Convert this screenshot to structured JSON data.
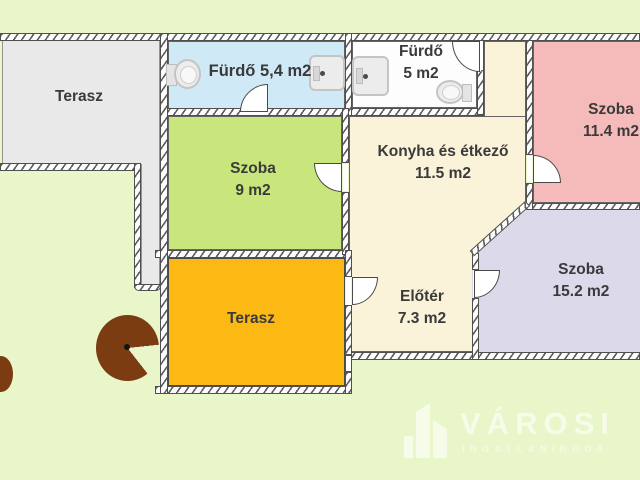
{
  "floorplan": {
    "background": "#e9f6c9",
    "wall_fill": "#fdfdfd",
    "wall_line": "#4f4f4f",
    "text_color": "#3a3a3a",
    "rooms": [
      {
        "name": "terasz-upper",
        "label": "Terasz",
        "area": "",
        "color": "#e9e9e9"
      },
      {
        "name": "furdo-small",
        "label": "Fürdő 5,4 m2",
        "area": "",
        "color": "#cfe9f6"
      },
      {
        "name": "furdo-large",
        "label": "Fürdő",
        "area": "5 m2",
        "color": "#fdfdfd"
      },
      {
        "name": "szoba-pink",
        "label": "Szoba",
        "area": "11.4 m2",
        "color": "#f5baba"
      },
      {
        "name": "szoba-green",
        "label": "Szoba",
        "area": "9 m2",
        "color": "#c9e67d"
      },
      {
        "name": "konyha-etkezo",
        "label": "Konyha és étkező",
        "area": "11.5 m2",
        "color": "#faf3da"
      },
      {
        "name": "eloter",
        "label": "Előtér",
        "area": "7.3 m2",
        "color": "#faf3da"
      },
      {
        "name": "szoba-purple",
        "label": "Szoba",
        "area": "15.2 m2",
        "color": "#dcdaea"
      },
      {
        "name": "terasz-lower",
        "label": "Terasz",
        "area": "",
        "color": "#fcb813"
      }
    ],
    "icons": {
      "toilet": "toilet-icon",
      "bathtub": "bathtub-icon",
      "door": "door-swing-icon",
      "tree": "tree-icon"
    },
    "tree_color": "#7a3c10"
  },
  "watermark": {
    "brand": "VÁROSI",
    "tagline": "INGATLANIRODA",
    "icon": "building-icon"
  }
}
